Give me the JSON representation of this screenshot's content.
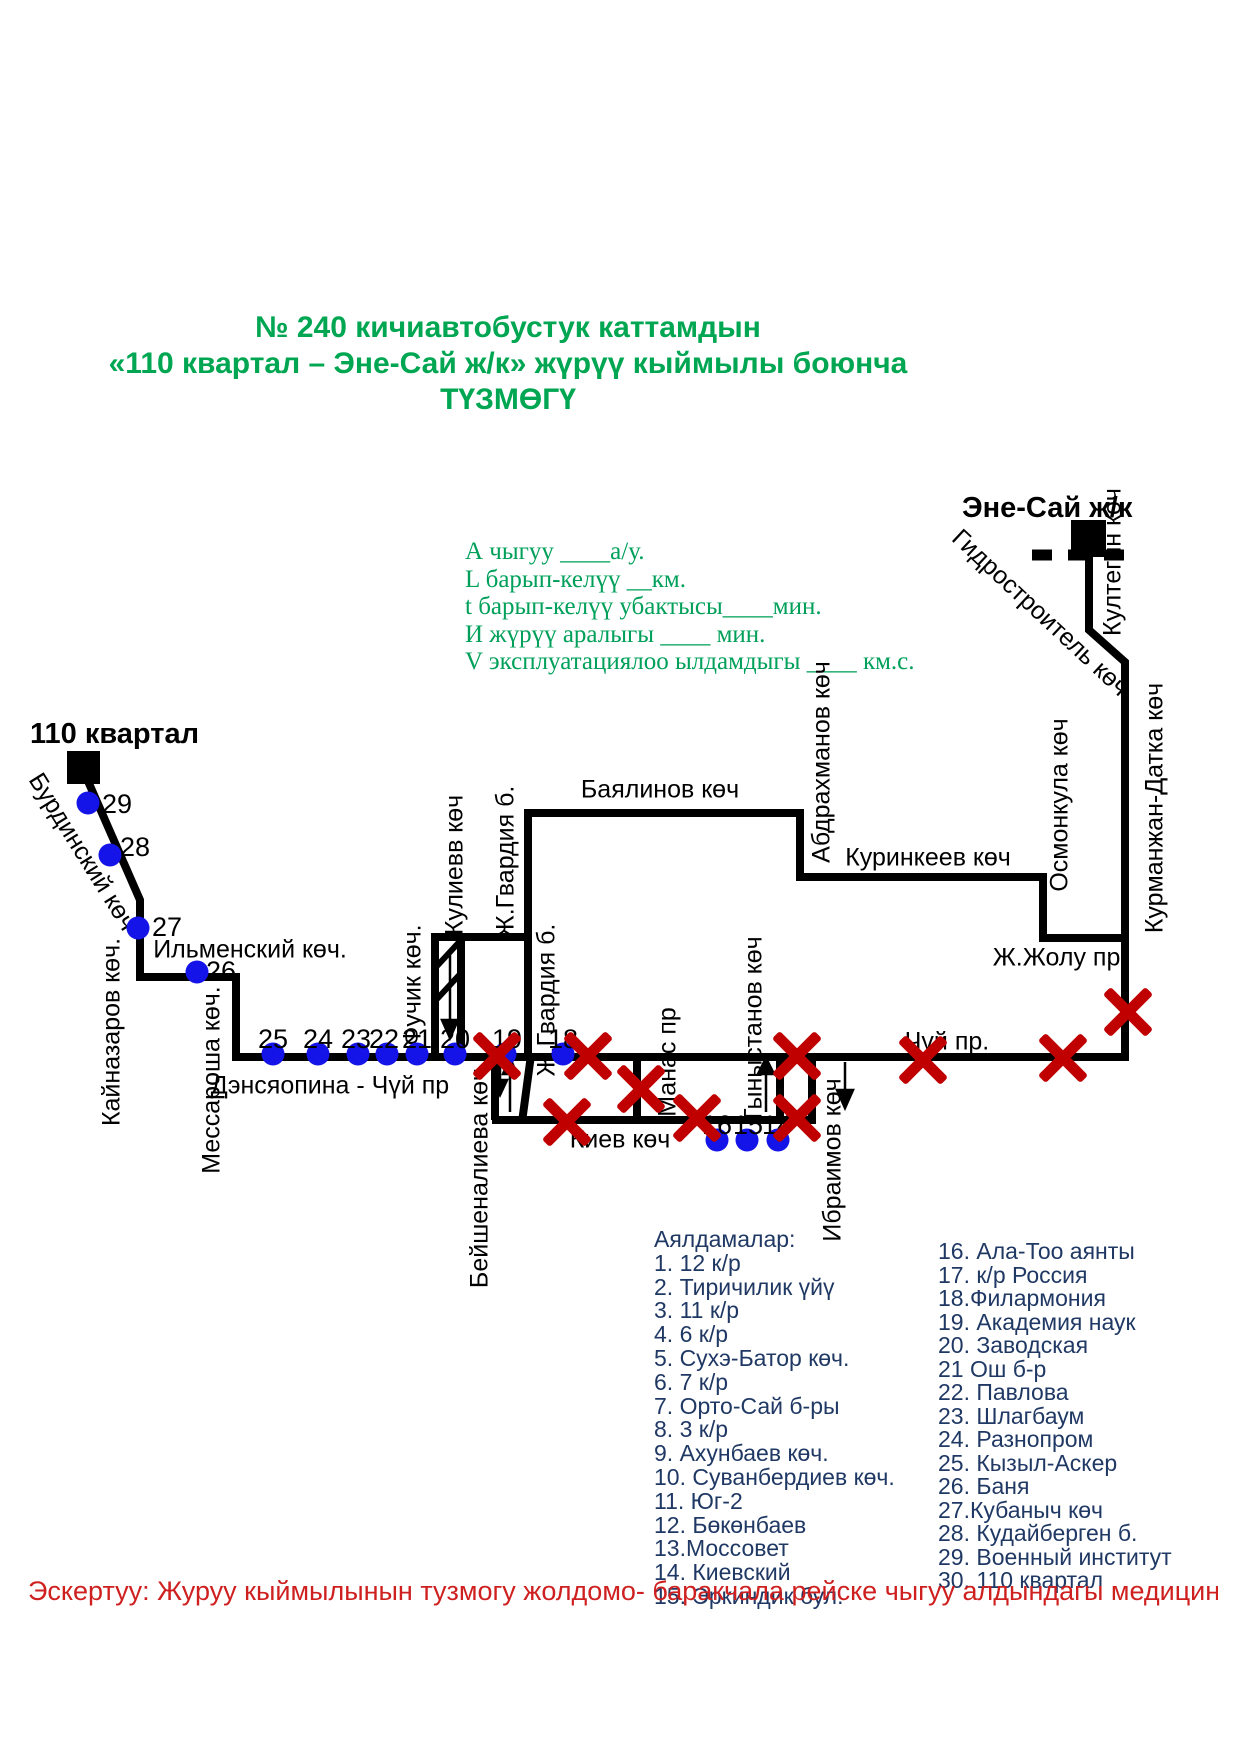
{
  "title": {
    "line1": "№ 240 кичиавтобустук каттамдын",
    "line2": "«110 квартал – Эне-Сай ж/к» жүрүү кыймылы  боюнча",
    "line3": "ТҮЗМӨГҮ"
  },
  "specs": {
    "lines": [
      "А чыгуу   ____а/у.",
      "L барып-келүү  __км.",
      "t барып-келүү убактысы____мин.",
      "И жүрүү аралыгы ____     мин.",
      "V эксплуатациялоо ылдамдыгы  ____ км.с."
    ]
  },
  "map": {
    "terminals": [
      {
        "label": "110 квартал",
        "x": 30,
        "y": 718
      },
      {
        "label": "Эне-Сай ж/к",
        "x": 962,
        "y": 492
      }
    ],
    "streets": [
      {
        "id": "burdinsky",
        "text": "Бурдинский көч",
        "cx": 82,
        "cy": 852,
        "rot": 58
      },
      {
        "id": "kaynazarov",
        "text": "Кайназаров көч.",
        "cx": 112,
        "cy": 1032,
        "rot": -90
      },
      {
        "id": "ilmensky",
        "text": "Ильменский көч.",
        "cx": 250,
        "cy": 950,
        "rot": 0
      },
      {
        "id": "messarosha",
        "text": "Мессароша көч.",
        "cx": 212,
        "cy": 1080,
        "rot": -90
      },
      {
        "id": "densyaopina-chuy",
        "text": "Дэнсяопина - Чүй пр",
        "cx": 330,
        "cy": 1086,
        "rot": 0
      },
      {
        "id": "fuchik",
        "text": "Фучик көч.",
        "cx": 413,
        "cy": 985,
        "rot": -90
      },
      {
        "id": "kuliev",
        "text": "Кулиевв көч",
        "cx": 455,
        "cy": 865,
        "rot": -90
      },
      {
        "id": "zh-gvardia-upper",
        "text": "Ж.Гвардия б.",
        "cx": 506,
        "cy": 862,
        "rot": -90
      },
      {
        "id": "zh-gvardia-lower",
        "text": "Ж.Гвардия б.",
        "cx": 547,
        "cy": 1000,
        "rot": -90
      },
      {
        "id": "bayalinov",
        "text": "Баялинов көч",
        "cx": 660,
        "cy": 790,
        "rot": 0
      },
      {
        "id": "abdrakhmanov",
        "text": "Абдрахманов көч",
        "cx": 822,
        "cy": 762,
        "rot": -90
      },
      {
        "id": "kurinkeev",
        "text": "Куринкеев көч",
        "cx": 928,
        "cy": 858,
        "rot": 0
      },
      {
        "id": "osmonkula",
        "text": "Осмонкула көч",
        "cx": 1060,
        "cy": 805,
        "rot": -90
      },
      {
        "id": "zh-zholu",
        "text": "Ж.Жолу пр.",
        "cx": 1060,
        "cy": 958,
        "rot": 0
      },
      {
        "id": "kurmanzhan-datka",
        "text": "Курманжан-Датка көч",
        "cx": 1155,
        "cy": 808,
        "rot": -90
      },
      {
        "id": "chuy",
        "text": "Чүй пр.",
        "cx": 947,
        "cy": 1042,
        "rot": 0
      },
      {
        "id": "gidrostroitel",
        "text": "Гидростроитель көч",
        "cx": 1040,
        "cy": 613,
        "rot": 43
      },
      {
        "id": "kultegin",
        "text": "Култегин  көч",
        "cx": 1113,
        "cy": 562,
        "rot": -90
      },
      {
        "id": "manas",
        "text": "Манас пр",
        "cx": 668,
        "cy": 1062,
        "rot": -90
      },
      {
        "id": "tynystanov",
        "text": "Тыныстанов көч",
        "cx": 754,
        "cy": 1030,
        "rot": -90
      },
      {
        "id": "ibraimov",
        "text": "Ибраимов көч",
        "cx": 833,
        "cy": 1160,
        "rot": -90
      },
      {
        "id": "beyshenalieva",
        "text": "Бейшеналиева көч",
        "cx": 480,
        "cy": 1178,
        "rot": -90
      },
      {
        "id": "kiev",
        "text": "Киев көч",
        "cx": 620,
        "cy": 1140,
        "rot": 0
      }
    ],
    "stops": [
      {
        "n": "29",
        "cx": 88,
        "cy": 803,
        "lx": 102,
        "ly": 789
      },
      {
        "n": "28",
        "cx": 110,
        "cy": 855,
        "lx": 120,
        "ly": 832
      },
      {
        "n": "27",
        "cx": 138,
        "cy": 928,
        "lx": 152,
        "ly": 912
      },
      {
        "n": "26",
        "cx": 197,
        "cy": 972,
        "lx": 206,
        "ly": 956
      },
      {
        "n": "25",
        "cx": 273,
        "cy": 1054,
        "lx": 258,
        "ly": 1024
      },
      {
        "n": "24",
        "cx": 318,
        "cy": 1054,
        "lx": 303,
        "ly": 1024
      },
      {
        "n": "23",
        "cx": 358,
        "cy": 1054,
        "lx": 341,
        "ly": 1024
      },
      {
        "n": "22",
        "cx": 387,
        "cy": 1054,
        "lx": 369,
        "ly": 1024
      },
      {
        "n": "21",
        "cx": 417,
        "cy": 1054,
        "lx": 402,
        "ly": 1024
      },
      {
        "n": "20",
        "cx": 455,
        "cy": 1054,
        "lx": 440,
        "ly": 1024
      },
      {
        "n": "19",
        "cx": 505,
        "cy": 1054,
        "lx": 492,
        "ly": 1024
      },
      {
        "n": "18",
        "cx": 563,
        "cy": 1054,
        "lx": 548,
        "ly": 1024
      },
      {
        "n": "16",
        "cx": 717,
        "cy": 1140,
        "lx": 702,
        "ly": 1110
      },
      {
        "n": "15",
        "cx": 747,
        "cy": 1140,
        "lx": 733,
        "ly": 1110
      },
      {
        "n": "14",
        "cx": 778,
        "cy": 1140,
        "lx": 762,
        "ly": 1110
      }
    ],
    "x_marks": [
      {
        "x": 497,
        "y": 1056
      },
      {
        "x": 588,
        "y": 1056
      },
      {
        "x": 641,
        "y": 1089
      },
      {
        "x": 567,
        "y": 1122
      },
      {
        "x": 697,
        "y": 1118
      },
      {
        "x": 797,
        "y": 1056
      },
      {
        "x": 797,
        "y": 1118
      },
      {
        "x": 923,
        "y": 1060
      },
      {
        "x": 1063,
        "y": 1058
      },
      {
        "x": 1128,
        "y": 1012
      }
    ],
    "colors": {
      "line": "#000000",
      "stop_dot": "#1414E8",
      "x_mark": "#C00000"
    }
  },
  "stop_list": {
    "header": "Аялдамалар:",
    "column1": [
      "1. 12 к/р",
      "2. Тиричилик үйү",
      "3. 11 к/р",
      "4. 6 к/р",
      "5. Сухэ-Батор көч.",
      "6. 7 к/р",
      "7. Орто-Сай б-ры",
      "8. 3 к/р",
      "9. Ахунбаев көч.",
      "10. Суванбердиев көч.",
      "11. Юг-2",
      "12. Бөкөнбаев",
      "13.Моссовет",
      "14. Киевский",
      "15. Эркиндик бул."
    ],
    "column2": [
      "16. Ала-Тоо аянты",
      "17. к/р Россия",
      "18.Филармония",
      "19. Академия наук",
      "20. Заводская",
      "21 Ош б-р",
      "22. Павлова",
      "23. Шлагбаум",
      "24. Разнопром",
      "25. Кызыл-Аскер",
      "26. Баня",
      "27.Кубаныч көч",
      "28. Кудайберген б.",
      "29. Военный институт",
      "30. 110 квартал"
    ]
  },
  "note": {
    "text": "Эскертуу: Журуу кыймылынын тузмогу жолдомо- баракчала  рейске чыгуу алдындагы медициналык"
  }
}
